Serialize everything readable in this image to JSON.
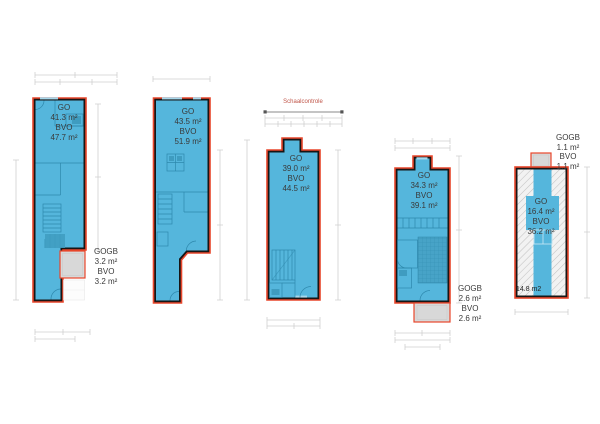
{
  "sheet": {
    "type": "floor-plan-set",
    "scale_control": {
      "label": "Schaalcontrole"
    }
  },
  "colors": {
    "living_area_fill": "#55b6dc",
    "detail_line_blue": "#2a84a8",
    "fixture_blue": "#3f9cc0",
    "wall_black": "#161616",
    "perimeter_red": "#e8462b",
    "exterior_gray_fill": "#d8d8d8",
    "hatch_gray": "#c2c2c2",
    "dimension_gray": "#cfcfcf",
    "label_text": "#3a3a3a"
  },
  "plans": [
    {
      "name": "unit-1",
      "area_label": [
        "GO",
        "41.3 m²",
        "BVO",
        "47.7 m²"
      ],
      "gogb_label": [
        "GOGB",
        "3.2 m²",
        "BVO",
        "3.2 m²"
      ]
    },
    {
      "name": "unit-2",
      "area_label": [
        "GO",
        "43.5 m²",
        "BVO",
        "51.9 m²"
      ]
    },
    {
      "name": "unit-3",
      "area_label": [
        "GO",
        "39.0 m²",
        "BVO",
        "44.5 m²"
      ]
    },
    {
      "name": "unit-4",
      "area_label": [
        "GO",
        "34.3 m²",
        "BVO",
        "39.1 m²"
      ],
      "gogb_label": [
        "GOGB",
        "2.6 m²",
        "BVO",
        "2.6 m²"
      ]
    },
    {
      "name": "unit-5",
      "area_label": [
        "GO",
        "16.4 m²",
        "BVO",
        "36.2 m²"
      ],
      "gogb_label": [
        "GOGB",
        "1.1 m²",
        "BVO",
        "1.1 m²"
      ],
      "floor_note": "14.8 m2"
    }
  ]
}
